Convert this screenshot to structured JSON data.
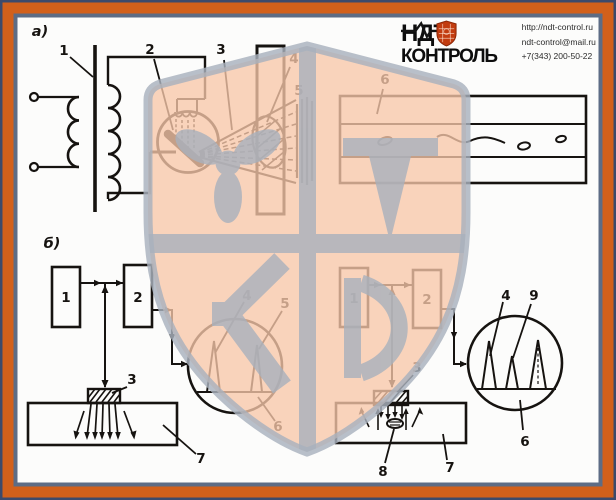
{
  "palette": {
    "frame_outer": "#3d4a6b",
    "frame_band": "#d2601b",
    "frame_inner_line": "#5d6c85",
    "paper": "#fcfcfb",
    "ink": "#161310",
    "watermark_fill": "#f7c6a9",
    "watermark_gray": "#a8b1bd",
    "emblem_red": "#c23c10"
  },
  "logo": {
    "name_top": "НДТ",
    "name_bottom": "КОНТРОЛЬ",
    "url": "http://ndt-control.ru",
    "email": "ndt-control@mail.ru",
    "phone": "+7(343) 200-50-22"
  },
  "figure": {
    "section_a_label": "а)",
    "section_b_label": "б)",
    "a_callouts": {
      "c1": "1",
      "c2": "2",
      "c3": "3",
      "c4": "4",
      "c5": "5",
      "c6": "6"
    },
    "b_left_callouts": {
      "c1": "1",
      "c2": "2",
      "c3": "3",
      "c4": "4",
      "c5": "5",
      "c6": "6",
      "c7": "7"
    },
    "b_right_callouts": {
      "c1": "1",
      "c2": "2",
      "c3": "3",
      "c4": "4",
      "c9": "9",
      "c6": "6",
      "c7": "7",
      "c8": "8"
    }
  }
}
